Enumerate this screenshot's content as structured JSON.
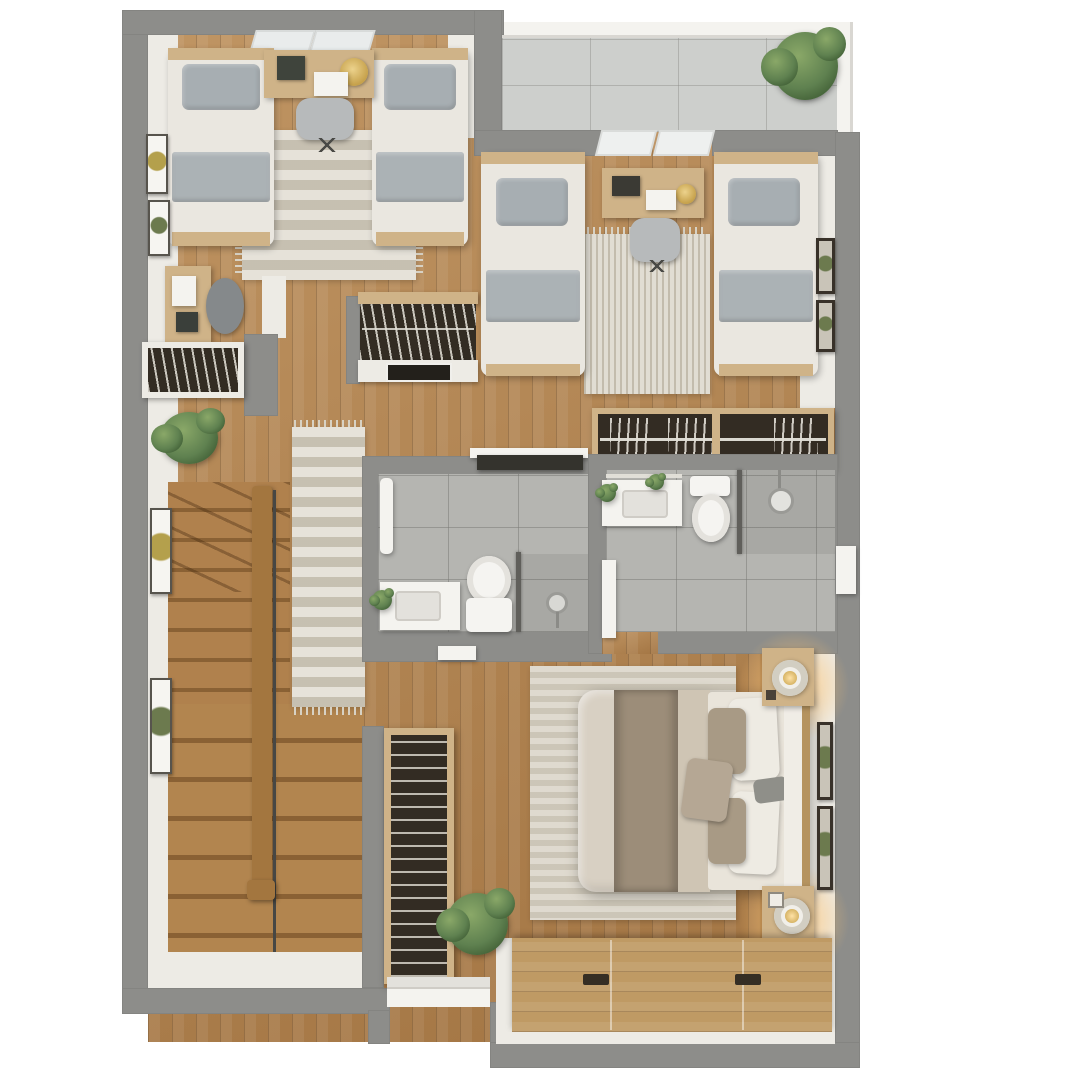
{
  "title": "3D floor plan - upper floor, top-down view",
  "palette": {
    "background": "#ffffff",
    "outer_wall": "#8d8d8a",
    "inner_wall": "#edebe5",
    "wood_floor": "#b1824e",
    "tile_bathroom": "#b5b5b1",
    "tile_balcony": "#cdcfcc",
    "rug_light": "#d6d0c2",
    "bed_linen": "#eae7e0",
    "pillow_gray": "#a7aeb2",
    "master_duvet": "#d8d0c3",
    "master_throw": "#9c8d79",
    "furniture_wood": "#cfb388",
    "dark_interior": "#332c23",
    "plant_green": "#5f8150",
    "lamp_gold": "#c6a14b",
    "lamp_glow": "#ffc985"
  },
  "rooms": [
    {
      "name": "bedroom-1",
      "position": "top-left",
      "furniture": [
        "twin bed",
        "twin bed",
        "desk with laptop, lamp and planter box",
        "office chair",
        "striped area rug",
        "two wall frames",
        "two windows"
      ]
    },
    {
      "name": "balcony",
      "position": "top-right",
      "furniture": [
        "tiled floor",
        "white railing",
        "potted plant"
      ]
    },
    {
      "name": "bedroom-2",
      "position": "upper-right",
      "furniture": [
        "twin bed",
        "twin bed",
        "desk with laptop and clock",
        "office chair",
        "area rug",
        "two wall frames",
        "two windows"
      ]
    },
    {
      "name": "hallway",
      "position": "center-left",
      "furniture": [
        "study desk",
        "office chair",
        "bookshelf counter",
        "potted plant",
        "runner rug",
        "wall bookcase unit with screen"
      ]
    },
    {
      "name": "staircase",
      "position": "lower-left",
      "furniture": [
        "wood treads",
        "winder steps",
        "center handrail",
        "two wall frames"
      ]
    },
    {
      "name": "bathroom-1",
      "position": "center",
      "furniture": [
        "vanity sink with plant",
        "toilet",
        "walk-in shower with glass divider",
        "towel rail",
        "dark wall shelf",
        "door"
      ]
    },
    {
      "name": "bathroom-2-ensuite",
      "position": "center-right",
      "furniture": [
        "vanity sink with plants",
        "towel bar",
        "toilet",
        "walk-in shower with round head",
        "glass divider",
        "door",
        "window panel"
      ]
    },
    {
      "name": "walk-in-closet",
      "position": "right",
      "furniture": [
        "hanging rail with clothes hangers",
        "wood frame"
      ]
    },
    {
      "name": "master-bedroom",
      "position": "bottom-right",
      "furniture": [
        "double bed with throw and pillows",
        "headboard",
        "two nightstands with lit lamps",
        "area rug",
        "storage bench with handles",
        "two wall frames",
        "tall shelving unit",
        "potted plant",
        "white steps"
      ]
    }
  ]
}
